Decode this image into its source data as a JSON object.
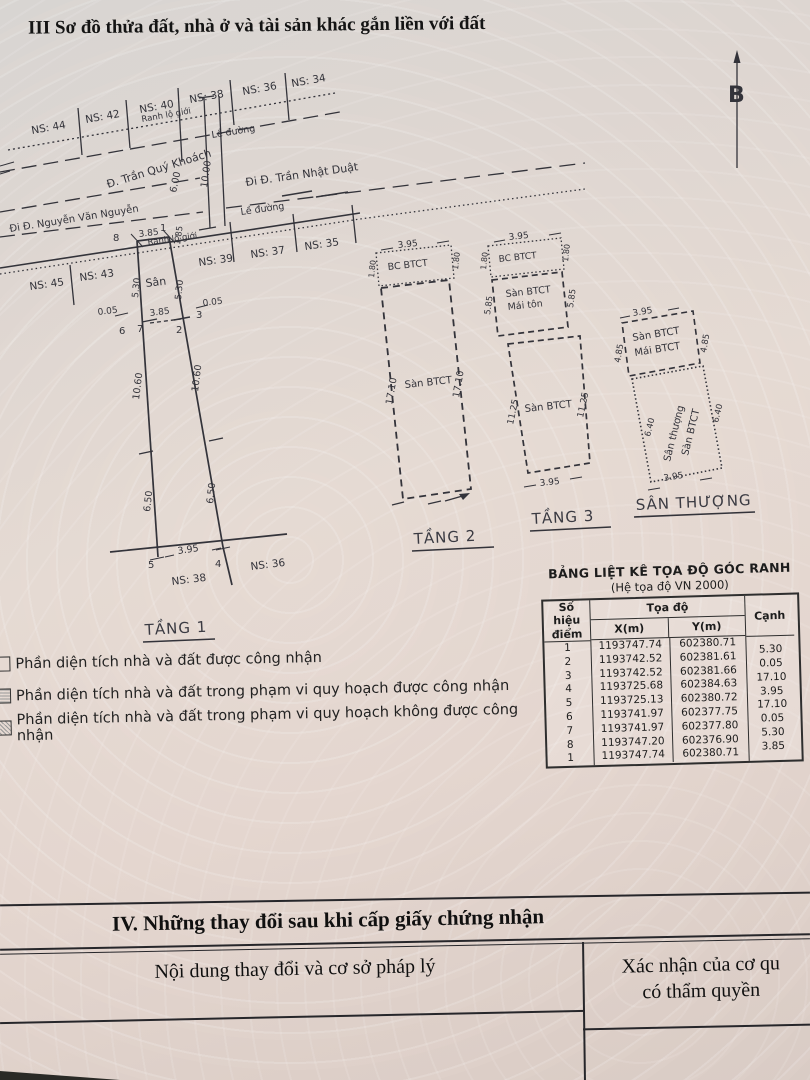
{
  "title": "III  Sơ đồ thửa đất, nhà ở và tài sản khác gắn liền với đất",
  "north_label": "B",
  "site": {
    "ns_top_0": "NS: 44",
    "ns_top_1": "NS: 42",
    "ns_top_2": "NS: 40",
    "ns_top_3": "NS: 38",
    "ns_top_4": "NS: 36",
    "ns_top_5": "NS: 34",
    "ns_front_0": "NS: 45",
    "ns_front_1": "NS: 43",
    "ns_front_2": "NS: 39",
    "ns_front_3": "NS: 37",
    "ns_front_4": "NS: 35",
    "ranh_lo_gioi_top": "Ranh lộ giới",
    "ranh_lo_gioi_front": "Ranh lộ giới",
    "le_duong_top": "Lề đường",
    "le_duong_front": "Lề đường",
    "street_tqk": "Đ. Trần Quý Khoách",
    "street_tnd": "Đi Đ. Trần Nhật Duật",
    "street_nvn": "Đi Đ. Nguyễn Văn Nguyễn",
    "dim_600": "6.00",
    "dim_1000": "10.00"
  },
  "floor1": {
    "label": "TẦNG 1",
    "san": "Sân",
    "p1": "1",
    "p2": "2",
    "p3": "3",
    "p4": "4",
    "p5": "5",
    "p6": "6",
    "p7": "7",
    "p8": "8",
    "dim_top": "3.85",
    "dim_corner": "1.85",
    "dim_left_530": "5.30",
    "dim_right_530": "5.30",
    "dim_005_left": "0.05",
    "dim_005_right": "0.05",
    "dim_front": "3.85",
    "dim_1060_left": "10.60",
    "dim_1060_right": "10.60",
    "dim_650_left": "6.50",
    "dim_650_right": "6.50",
    "dim_bottom": "3.95",
    "ns_38": "NS: 38",
    "ns_36": "NS: 36"
  },
  "floor2": {
    "label": "TẦNG 2",
    "dim_top": "3.95",
    "bc": "BC BTCT",
    "bc_left": "1.80",
    "bc_right": "1.80",
    "san": "Sàn BTCT",
    "side_left": "17.10",
    "side_right": "17.10"
  },
  "floor3": {
    "label": "TẦNG 3",
    "dim_top": "3.95",
    "bc": "BC BTCT",
    "bc_left": "1.80",
    "bc_right": "1.80",
    "upper1": "Sàn BTCT",
    "upper2": "Mái tôn",
    "upper_left": "5.85",
    "upper_right": "5.85",
    "lower": "Sàn BTCT",
    "lower_left": "11.25",
    "lower_right": "11.25",
    "dim_bottom": "3.95"
  },
  "roof": {
    "label": "SÂN THƯỢNG",
    "dim_top": "3.95",
    "upper1": "Sàn BTCT",
    "upper2": "Mái BTCT",
    "upper_left": "4.85",
    "upper_right": "4.85",
    "lower1": "Sân thượng",
    "lower2": "Sàn BTCT",
    "lower_left": "6.40",
    "lower_right": "6.40",
    "dim_bottom": "3.95"
  },
  "coord_table": {
    "title": "BẢNG LIỆT KÊ TỌA ĐỘ GÓC RANH",
    "subtitle": "(Hệ tọa độ VN 2000)",
    "col_point_1": "Số hiệu",
    "col_point_2": "điểm",
    "col_coord": "Tọa độ",
    "col_x": "X(m)",
    "col_y": "Y(m)",
    "col_edge": "Cạnh",
    "rows": [
      {
        "p": "1",
        "x": "1193747.74",
        "y": "602380.71"
      },
      {
        "p": "2",
        "x": "1193742.52",
        "y": "602381.61"
      },
      {
        "p": "3",
        "x": "1193742.52",
        "y": "602381.66"
      },
      {
        "p": "4",
        "x": "1193725.68",
        "y": "602384.63"
      },
      {
        "p": "5",
        "x": "1193725.13",
        "y": "602380.72"
      },
      {
        "p": "6",
        "x": "1193741.97",
        "y": "602377.75"
      },
      {
        "p": "7",
        "x": "1193741.97",
        "y": "602377.80"
      },
      {
        "p": "8",
        "x": "1193747.20",
        "y": "602376.90"
      },
      {
        "p": "1",
        "x": "1193747.74",
        "y": "602380.71"
      }
    ],
    "edges": [
      "5.30",
      "0.05",
      "17.10",
      "3.95",
      "17.10",
      "0.05",
      "5.30",
      "3.85"
    ]
  },
  "legend": [
    "Phần diện tích nhà và đất được công nhận",
    "Phần diện tích nhà và đất trong phạm vi quy hoạch được công nhận",
    "Phần diện tích nhà và đất trong phạm vi quy hoạch không được công nhận"
  ],
  "section4": {
    "title": "IV. Những thay đổi sau khi cấp giấy chứng nhận",
    "col_left": "Nội dung thay đổi và cơ sở pháp lý",
    "col_right_1": "Xác nhận của cơ qu",
    "col_right_2": "có thẩm quyền"
  },
  "colors": {
    "ink": "#33333a",
    "paper": "#e2d6cf"
  }
}
